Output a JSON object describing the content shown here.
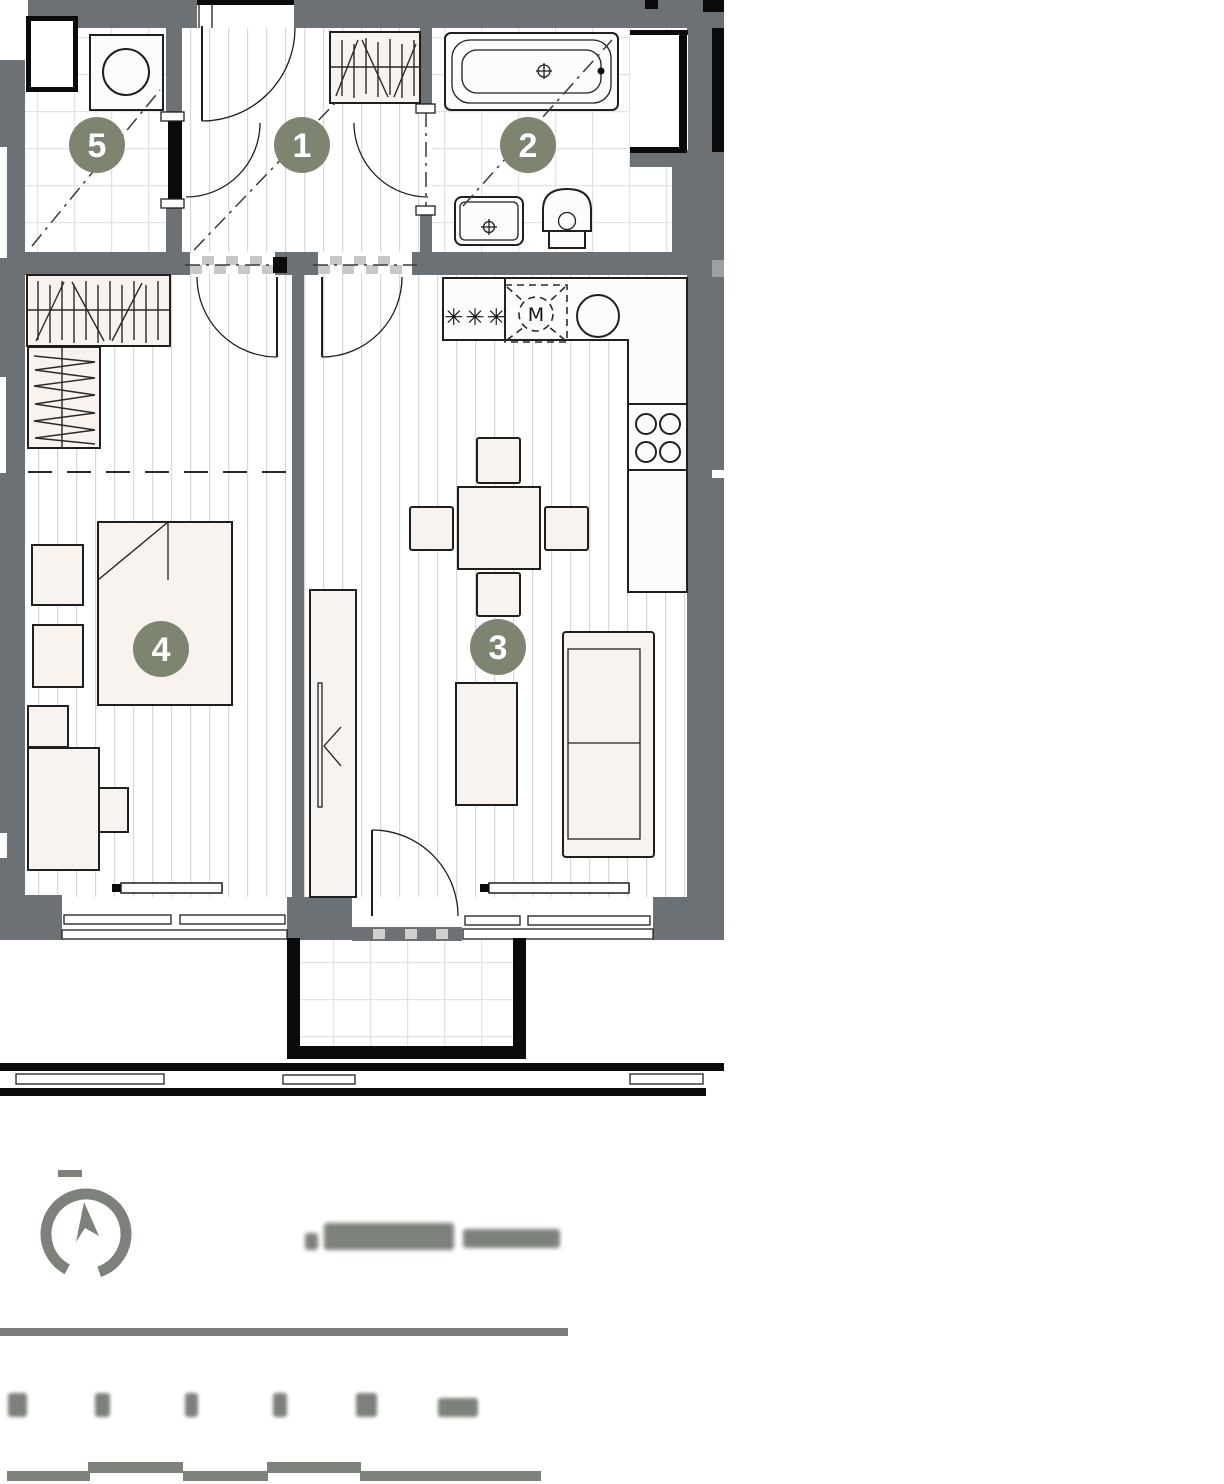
{
  "colors": {
    "wall": "#6b7174",
    "badge": "#7d8571",
    "outline": "#1f1f1f",
    "furniture": "#f9f3ef",
    "fixture": "#fdfcfa",
    "accent_black": "#0b0b0b",
    "floor_line": "#d8d8d8",
    "tile_line": "#e3e3e3",
    "footer_gray": "#7c817a",
    "divider_gray": "#7b7b7b"
  },
  "plan": {
    "badges": [
      {
        "number": "1"
      },
      {
        "number": "2"
      },
      {
        "number": "3"
      },
      {
        "number": "4"
      },
      {
        "number": "5"
      }
    ],
    "kitchen": {
      "m_label": "M",
      "appliance_symbol": "✳✳✳"
    }
  }
}
